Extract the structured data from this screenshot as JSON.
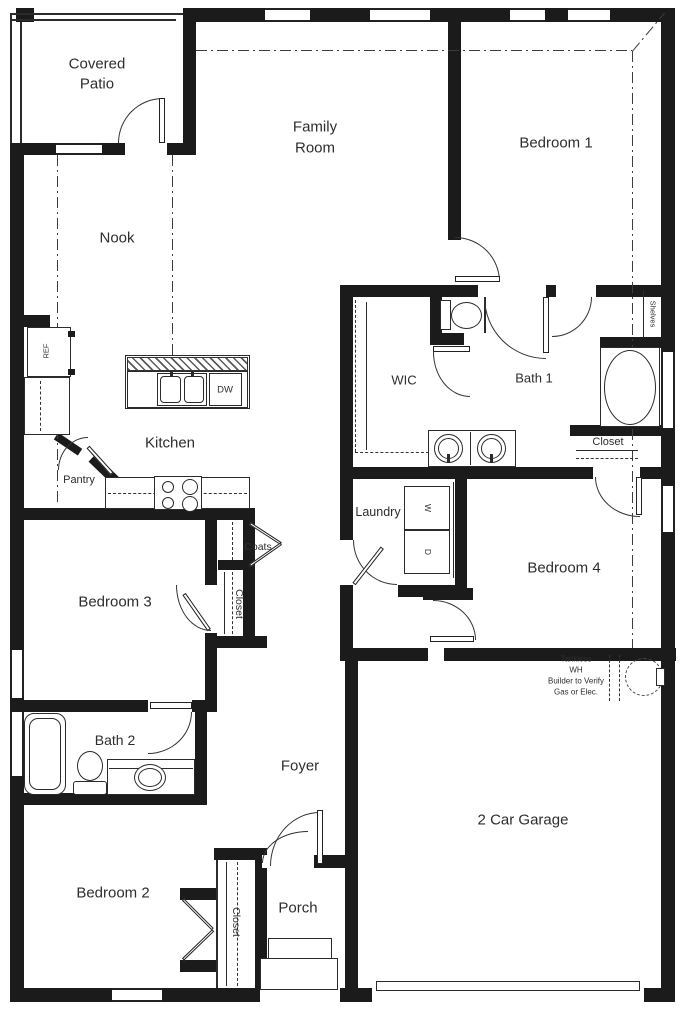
{
  "labels": {
    "covered_patio_1": "Covered",
    "covered_patio_2": "Patio",
    "family_room_1": "Family",
    "family_room_2": "Room",
    "bedroom1": "Bedroom 1",
    "nook": "Nook",
    "kitchen": "Kitchen",
    "pantry": "Pantry",
    "ref": "REF",
    "dw": "DW",
    "wic": "WIC",
    "bath1": "Bath 1",
    "shelves": "Shelves",
    "closet_linen": "Closet",
    "laundry": "Laundry",
    "washer": "W",
    "dryer": "D",
    "bedroom4": "Bedroom 4",
    "coats": "Coats",
    "closet_bed3": "Closet",
    "bedroom3": "Bedroom 3",
    "bath2": "Bath 2",
    "foyer": "Foyer",
    "bedroom2": "Bedroom 2",
    "closet_bed2": "Closet",
    "porch": "Porch",
    "garage": "2 Car Garage",
    "wh_note_1": "Tankless",
    "wh_note_2": "WH",
    "wh_note_3": "Builder to Verify",
    "wh_note_4": "Gas or Elec."
  },
  "colors": {
    "wall": "#1b1b1b",
    "line": "#2b2b2b",
    "text": "#2e2e2e"
  }
}
